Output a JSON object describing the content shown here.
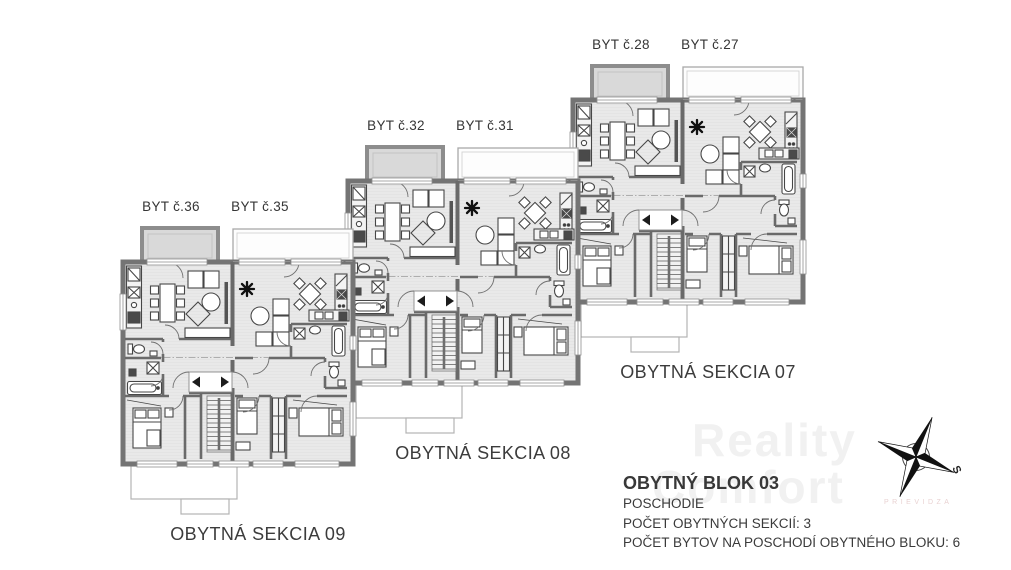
{
  "floor_plan": {
    "sections": [
      {
        "name": "OBYTNÁ SEKCIA 07",
        "apartment_left": "BYT č.28",
        "apartment_right": "BYT č.27"
      },
      {
        "name": "OBYTNÁ SEKCIA 08",
        "apartment_left": "BYT č.32",
        "apartment_right": "BYT č.31"
      },
      {
        "name": "OBYTNÁ SEKCIA 09",
        "apartment_left": "BYT č.36",
        "apartment_right": "BYT č.35"
      }
    ],
    "info": {
      "title": "OBYTNÝ BLOK 03",
      "line1": "POSCHODIE",
      "line2": "POČET OBYTNÝCH SEKCIÍ: 3",
      "line3": "POČET BYTOV NA POSCHODÍ OBYTNÉHO BLOKU: 6"
    },
    "compass": {
      "south_label": "S"
    },
    "watermark": {
      "line1": "Reality",
      "line2": "Comfort",
      "line3": "PRIEVIDZA"
    },
    "colors": {
      "wall": "#6e6e6e",
      "outer_wall": "#747474",
      "floor": "#e9e9e9",
      "balcony_fill": "#d9d9d9",
      "outline": "#b3b3b3",
      "text": "#3a3a3a"
    }
  }
}
